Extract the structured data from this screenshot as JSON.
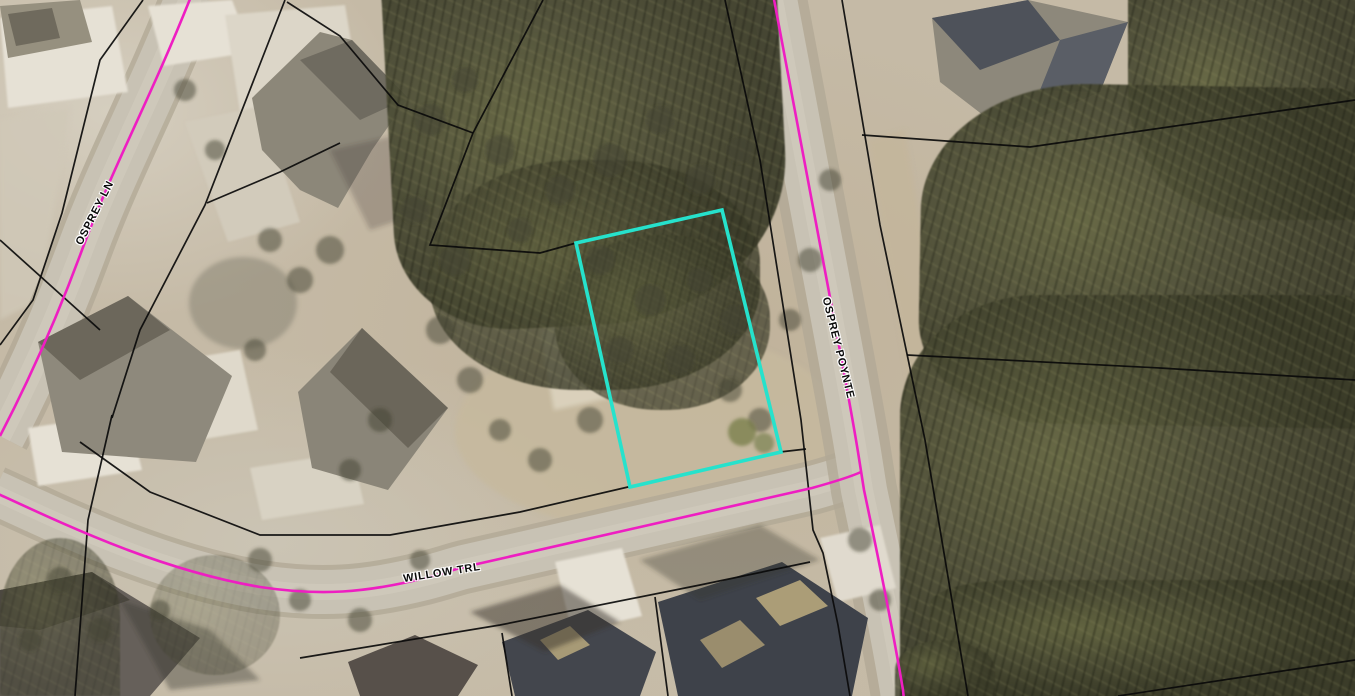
{
  "map": {
    "type": "aerial-parcel-map",
    "road_labels": [
      {
        "id": "osprey-ln",
        "text": "OSPREY LN"
      },
      {
        "id": "willow-trl",
        "text": "WILLOW TRL"
      },
      {
        "id": "osprey-poynte",
        "text": "OSPREY POYNTE"
      }
    ],
    "colors": {
      "road_centerline": "#ee1ec2",
      "highlight_parcel": "#26e2cc",
      "parcel_boundary": "#0a0a0a",
      "ground": "#c5baa6",
      "road_surface": "#c8c2b4",
      "road_shoulder": "#b2a996",
      "forest": "#565440"
    },
    "highlight_parcel": {
      "points": [
        [
          576,
          243
        ],
        [
          722,
          210
        ],
        [
          781,
          452
        ],
        [
          630,
          487
        ]
      ]
    },
    "roads": [
      {
        "name": "OSPREY LN",
        "path": "M192,-6 C150,100 112,168 82,250 C57,318 27,384 0,436",
        "surface_width": 50,
        "shoulder_width": 60
      },
      {
        "name": "WILLOW TRL",
        "path": "M-6,492 C70,527 160,570 260,587 C320,596 365,593 425,578 C445,573 452,570 464,567 L812,488 Q848,478 861,472",
        "surface_width": 44,
        "shoulder_width": 54
      },
      {
        "name": "OSPREY POYNTE",
        "path": "M773,-6 C795,110 812,200 822,255 C840,350 852,415 858,452 L864,490 C878,556 892,625 903,690 L904,700",
        "surface_width": 46,
        "shoulder_width": 66
      }
    ],
    "parcel_lines": [
      [
        [
          143,
          0
        ],
        [
          100,
          60
        ],
        [
          62,
          213
        ],
        [
          33,
          300
        ],
        [
          0,
          345
        ]
      ],
      [
        [
          0,
          240
        ],
        [
          100,
          330
        ]
      ],
      [
        [
          285,
          0
        ],
        [
          205,
          205
        ],
        [
          140,
          330
        ],
        [
          112,
          418
        ]
      ],
      [
        [
          112,
          415
        ],
        [
          88,
          520
        ],
        [
          75,
          696
        ]
      ],
      [
        [
          80,
          442
        ],
        [
          150,
          492
        ],
        [
          260,
          535
        ],
        [
          390,
          535
        ],
        [
          520,
          512
        ],
        [
          628,
          487
        ],
        [
          780,
          452
        ],
        [
          806,
          449
        ]
      ],
      [
        [
          725,
          0
        ],
        [
          760,
          160
        ],
        [
          790,
          350
        ],
        [
          801,
          420
        ],
        [
          813,
          530
        ],
        [
          823,
          553
        ],
        [
          838,
          625
        ],
        [
          850,
          696
        ]
      ],
      [
        [
          842,
          0
        ],
        [
          880,
          225
        ],
        [
          925,
          440
        ],
        [
          968,
          696
        ]
      ],
      [
        [
          862,
          135
        ],
        [
          1030,
          147
        ],
        [
          1355,
          100
        ]
      ],
      [
        [
          907,
          355
        ],
        [
          1160,
          368
        ],
        [
          1355,
          380
        ]
      ],
      [
        [
          1118,
          696
        ],
        [
          1355,
          660
        ]
      ],
      [
        [
          543,
          0
        ],
        [
          473,
          133
        ]
      ],
      [
        [
          473,
          133
        ],
        [
          398,
          105
        ],
        [
          340,
          36
        ],
        [
          287,
          2
        ]
      ],
      [
        [
          473,
          133
        ],
        [
          430,
          245
        ],
        [
          540,
          253
        ],
        [
          576,
          243
        ]
      ],
      [
        [
          300,
          658
        ],
        [
          500,
          625
        ],
        [
          700,
          585
        ],
        [
          810,
          562
        ]
      ],
      [
        [
          502,
          633
        ],
        [
          512,
          696
        ]
      ],
      [
        [
          655,
          597
        ],
        [
          668,
          696
        ]
      ],
      [
        [
          207,
          203
        ],
        [
          280,
          172
        ],
        [
          340,
          143
        ]
      ]
    ]
  }
}
